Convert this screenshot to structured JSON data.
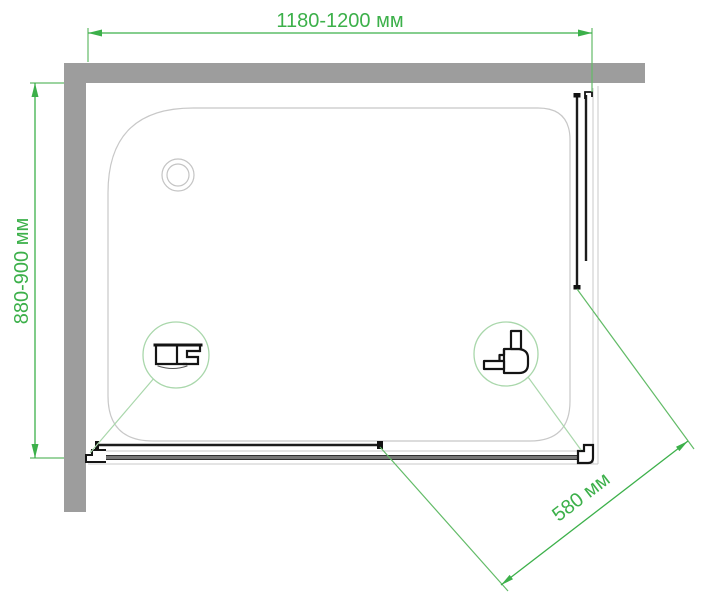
{
  "drawing": {
    "dimensions": {
      "width": {
        "label": "1180-1200 мм"
      },
      "depth": {
        "label": "880-900 мм"
      },
      "entry": {
        "label": "580 мм"
      }
    },
    "colors": {
      "dimension_green": "#3cb04a",
      "leader_green": "#62bb67",
      "detail_circle_green": "#a9d7ab",
      "wall_gray": "#9d9d9d",
      "tray_outline_gray": "#c8c8c8",
      "profile_black": "#161616",
      "rail_gray": "#777777"
    }
  }
}
